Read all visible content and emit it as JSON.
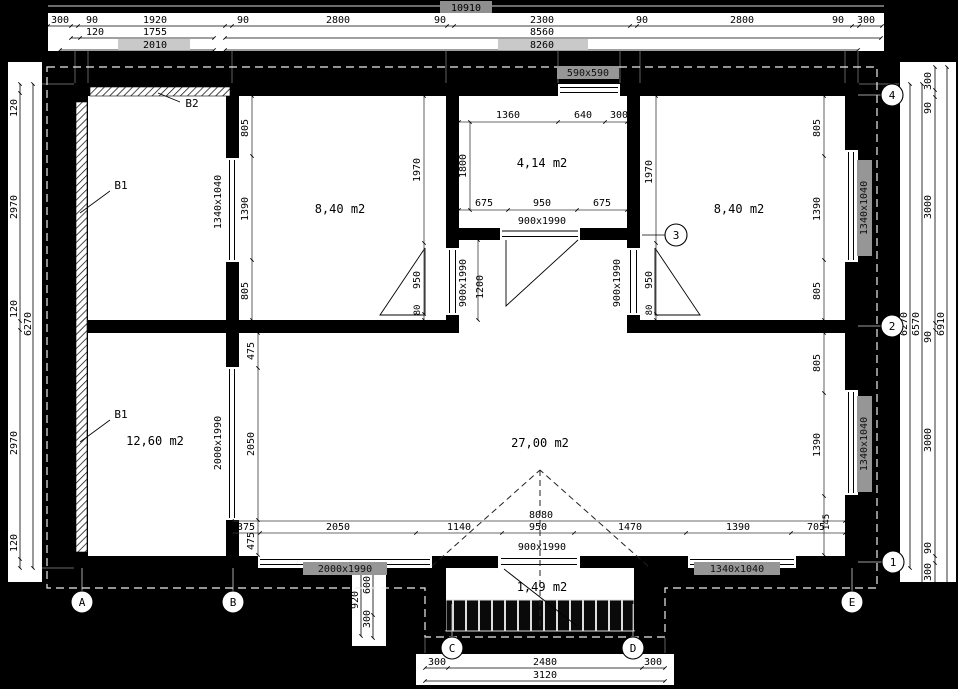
{
  "drawing": {
    "rooms": {
      "left_top": "8,40 m2",
      "center_top": "4,14 m2",
      "right_top": "8,40 m2",
      "left_bottom": "12,60 m2",
      "main": "27,00 m2",
      "porch": "1,49 m2"
    },
    "wall_tags": {
      "b2": "B2",
      "b1_upper": "B1",
      "b1_lower": "B1"
    },
    "openings": {
      "top_window": "590x590",
      "annex_window": "1340x1040",
      "center_door": "900x1990",
      "left_door": "900x1990",
      "right_door": "900x1990",
      "annex_lower_window": "2000x1990",
      "bottom_left_window": "2000x1990",
      "bottom_door": "900x1990",
      "bottom_right_window": "1340x1040",
      "right_upper_window": "1340x1040",
      "right_lower_window": "1340x1040"
    },
    "grid": {
      "a": "A",
      "b": "B",
      "c": "C",
      "d": "D",
      "e": "E",
      "n1": "1",
      "n2": "2",
      "n3": "3",
      "n4": "4"
    },
    "dims": {
      "top_total": "10910",
      "top_row1": [
        "300",
        "90",
        "1920",
        "90",
        "2800",
        "90",
        "2300",
        "90",
        "2800",
        "90",
        "300"
      ],
      "top_row2": [
        "120",
        "1755",
        "8560"
      ],
      "top_row3": [
        "2010",
        "8260"
      ],
      "right_col": [
        "300",
        "90",
        "3000",
        "90",
        "3000",
        "90",
        "300"
      ],
      "right_totals": [
        "6270",
        "6570",
        "6910"
      ],
      "left_col": [
        "120",
        "2970",
        "120",
        "2970",
        "120"
      ],
      "left_total": "6270",
      "porch_row": [
        "300",
        "2480",
        "300"
      ],
      "porch_total": "3120",
      "porch_side": [
        "920",
        "600",
        "300"
      ],
      "room_lt_v": [
        "805",
        "1390",
        "805"
      ],
      "door_lt": [
        "1970",
        "950",
        "80"
      ],
      "room_rt_v": [
        "805",
        "1390",
        "805"
      ],
      "door_rt": [
        "1970",
        "950",
        "80"
      ],
      "ct_top": [
        "1360",
        "640",
        "300"
      ],
      "ct_bottom": [
        "675",
        "950",
        "675"
      ],
      "ct_left": "1800",
      "corridor_w": "1200",
      "lb_v": [
        "475",
        "2050",
        "475"
      ],
      "rb_v": [
        "805",
        "1390"
      ],
      "bottom_inner": [
        "375",
        "2050",
        "1140",
        "950",
        "1470",
        "1390",
        "705"
      ],
      "bottom_inner_total": "8080",
      "bottom_inner_small": "145"
    }
  }
}
